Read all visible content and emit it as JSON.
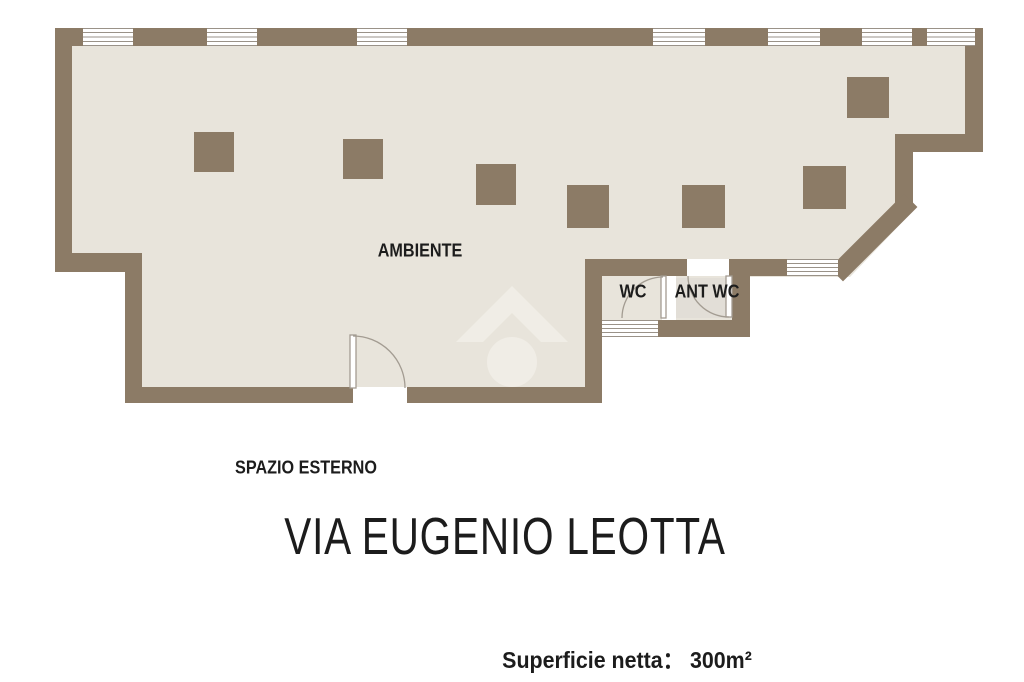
{
  "plan": {
    "room_labels": {
      "ambiente": "AMBIENTE",
      "wc": "WC",
      "ant_wc": "ANT WC"
    },
    "outside_label": "SPAZIO ESTERNO",
    "watermark_icon": "house-icon"
  },
  "footer": {
    "street_title": "VIA EUGENIO LEOTTA",
    "net_area": "Superficie netta： 300m²"
  },
  "colors": {
    "background": "#ffffff",
    "wall": "#8c7b66",
    "floor": "#e8e4db",
    "window_line": "#9a9288",
    "door_line": "#a39c92",
    "text": "#1c1c1c",
    "antwc_shading": "#e2ded7",
    "watermark": "#f2efe8"
  }
}
